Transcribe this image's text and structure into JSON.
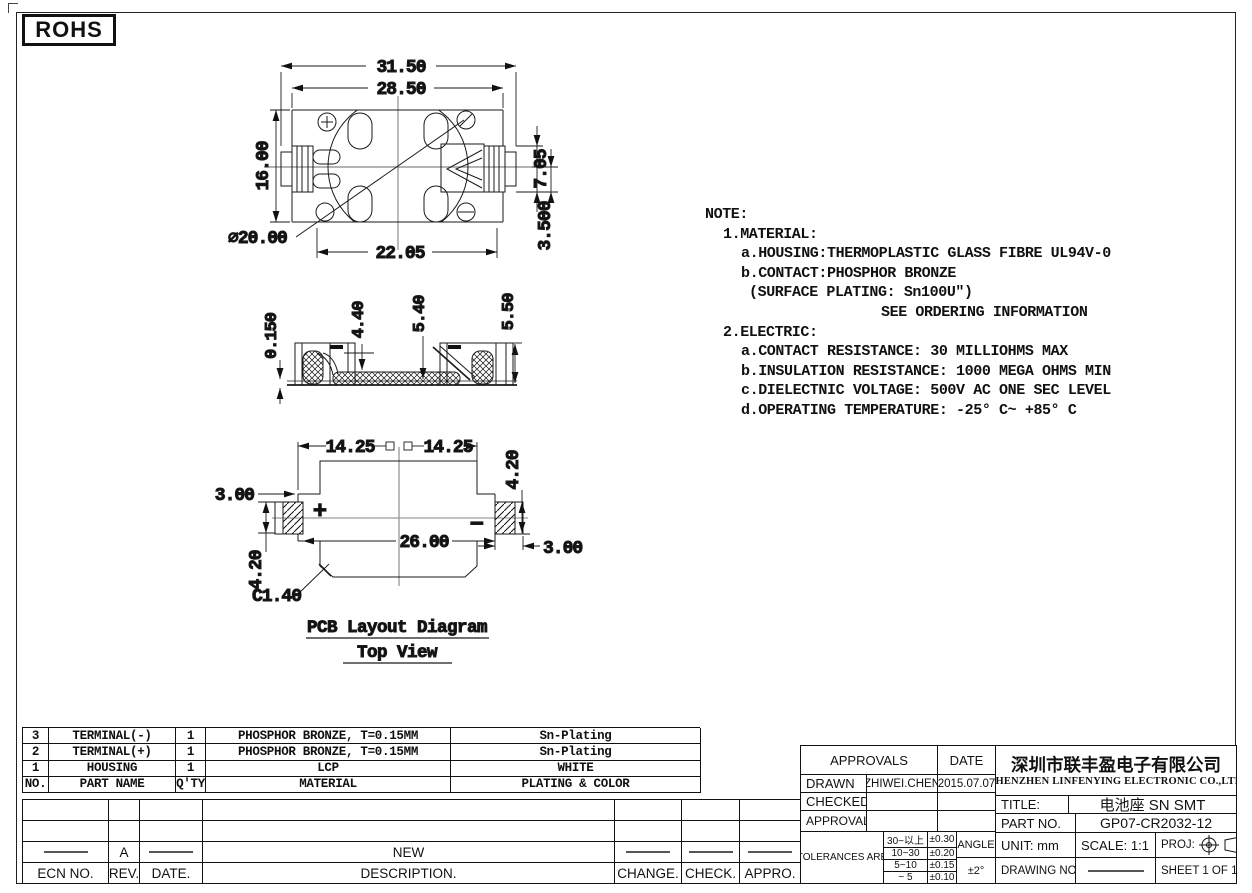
{
  "rohs": "ROHS",
  "views": {
    "top": {
      "d_3150": "31.50",
      "d_2850": "28.50",
      "d_1600": "16.00",
      "d_705": "7.05",
      "d_3500": "3.500",
      "d_dia20": "⌀20.00",
      "d_2205": "22.05"
    },
    "side": {
      "d_0150": "0.150",
      "d_440": "4.40",
      "d_540": "5.40",
      "d_550": "5.50"
    },
    "pcb": {
      "d_1425_left": "14.25",
      "d_1425_right": "14.25",
      "d_300_top": "3.00",
      "d_420_right": "4.20",
      "d_2600": "26.00",
      "d_300_bottom": "3.00",
      "d_420_left": "4.20",
      "d_c140": "C1.40",
      "plus": "+",
      "minus": "−",
      "caption_line1": "PCB Layout Diagram",
      "caption_line2": "Top View"
    }
  },
  "note": {
    "lines": [
      "NOTE:",
      "1.MATERIAL:",
      "a.HOUSING:THERMOPLASTIC GLASS FIBRE UL94V-0",
      "b.CONTACT:PHOSPHOR BRONZE",
      "(SURFACE PLATING: Sn100U″)",
      "SEE ORDERING INFORMATION",
      "2.ELECTRIC:",
      "a.CONTACT RESISTANCE: 30 MILLIOHMS MAX",
      "b.INSULATION RESISTANCE: 1000 MEGA OHMS MIN",
      "c.DIELECTNIC VOLTAGE: 500V AC ONE SEC LEVEL",
      "d.OPERATING TEMPERATURE: -25° C~ +85° C"
    ]
  },
  "parts": {
    "headers": [
      "NO.",
      "PART NAME",
      "Q'TY",
      "MATERIAL",
      "PLATING & COLOR"
    ],
    "rows": [
      [
        "3",
        "TERMINAL(-)",
        "1",
        "PHOSPHOR BRONZE, T=0.15MM",
        "Sn-Plating"
      ],
      [
        "2",
        "TERMINAL(+)",
        "1",
        "PHOSPHOR BRONZE, T=0.15MM",
        "Sn-Plating"
      ],
      [
        "1",
        "HOUSING",
        "1",
        "LCP",
        "WHITE"
      ]
    ]
  },
  "revision": {
    "headers": [
      "ECN NO.",
      "REV.",
      "DATE.",
      "DESCRIPTION.",
      "CHANGE.",
      "CHECK.",
      "APPRO."
    ],
    "entry_rev": "A",
    "entry_description": "NEW"
  },
  "title_block": {
    "approvals_header": "APPROVALS",
    "date_header": "DATE",
    "drawn_label": "DRAWN",
    "drawn_name": "ZHIWEI.CHEN",
    "drawn_date": "2015.07.07",
    "checked_label": "CHECKED",
    "approvals_label": "APPROVALS",
    "tolerances_label": "TOLERANCES ARE",
    "tol_rows": [
      [
        "30~以上",
        "±0.30"
      ],
      [
        "10~30",
        "±0.20"
      ],
      [
        "5~10",
        "±0.15"
      ],
      [
        "~ 5",
        "±0.10"
      ]
    ],
    "angle_label": "ANGLE",
    "angle_value": "±2°",
    "company_cn": "深圳市联丰盈电子有限公司",
    "company_en": "SHENZHEN LINFENYING ELECTRONIC CO.,LTD",
    "title_label": "TITLE:",
    "title_value": "电池座 SN SMT",
    "part_no_label": "PART NO.",
    "part_no_value": "GP07-CR2032-12",
    "unit_label": "UNIT: mm",
    "scale_label": "SCALE: 1:1",
    "proj_label": "PROJ:",
    "drawing_no_label": "DRAWING NO.",
    "sheet_label": "SHEET  1 OF 1"
  }
}
